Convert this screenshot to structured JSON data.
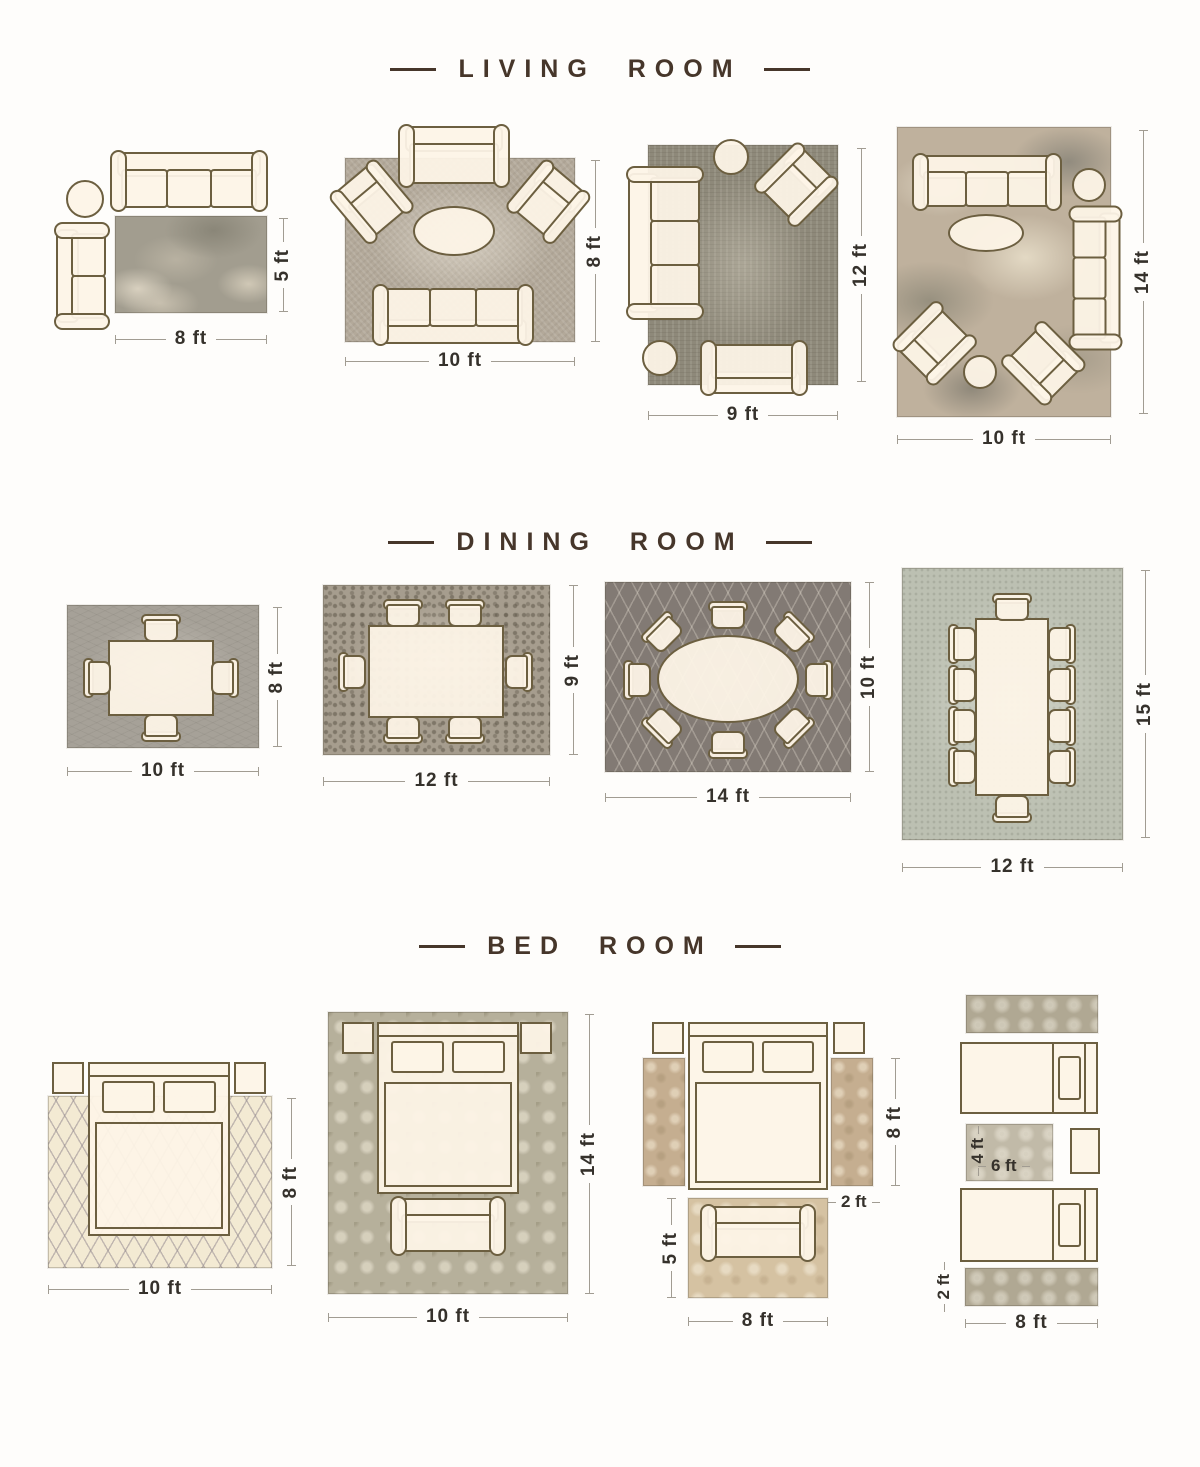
{
  "palette": {
    "background": "#fefdfb",
    "title_color": "#46362a",
    "furniture_fill": "#fdf4e7",
    "furniture_outline": "#6c5f40",
    "label_color": "#35312b",
    "dimension_line_color": "#a19c92"
  },
  "sections": [
    {
      "id": "living-room",
      "title": "LIVING ROOM",
      "layouts": [
        {
          "rug_size": "5x8",
          "width_label": "8 ft",
          "height_label": "5 ft"
        },
        {
          "rug_size": "8x10",
          "width_label": "10 ft",
          "height_label": "8 ft"
        },
        {
          "rug_size": "9x12",
          "width_label": "9 ft",
          "height_label": "12 ft"
        },
        {
          "rug_size": "10x14",
          "width_label": "10 ft",
          "height_label": "14 ft"
        }
      ]
    },
    {
      "id": "dining-room",
      "title": "DINING ROOM",
      "layouts": [
        {
          "rug_size": "8x10",
          "width_label": "10 ft",
          "height_label": "8 ft"
        },
        {
          "rug_size": "9x12",
          "width_label": "12 ft",
          "height_label": "9 ft"
        },
        {
          "rug_size": "10x14",
          "width_label": "14 ft",
          "height_label": "10 ft"
        },
        {
          "rug_size": "12x15",
          "width_label": "12 ft",
          "height_label": "15 ft"
        }
      ]
    },
    {
      "id": "bed-room",
      "title": "BED ROOM",
      "layouts": [
        {
          "rug_size": "8x10",
          "width_label": "10 ft",
          "height_label": "8 ft"
        },
        {
          "rug_size": "10x14",
          "width_label": "10 ft",
          "height_label": "14 ft"
        },
        {
          "rug_size": "runners-2x8-plus-5x8",
          "runner_height_label": "8 ft",
          "runner_width_label": "2 ft",
          "accent_height_label": "5 ft",
          "accent_width_label": "8 ft"
        },
        {
          "rug_size": "runners-2x8-plus-4x6",
          "mid_height_label": "4 ft",
          "mid_width_label": "6 ft",
          "runner_height_label": "2 ft",
          "runner_width_label": "8 ft"
        }
      ]
    }
  ]
}
